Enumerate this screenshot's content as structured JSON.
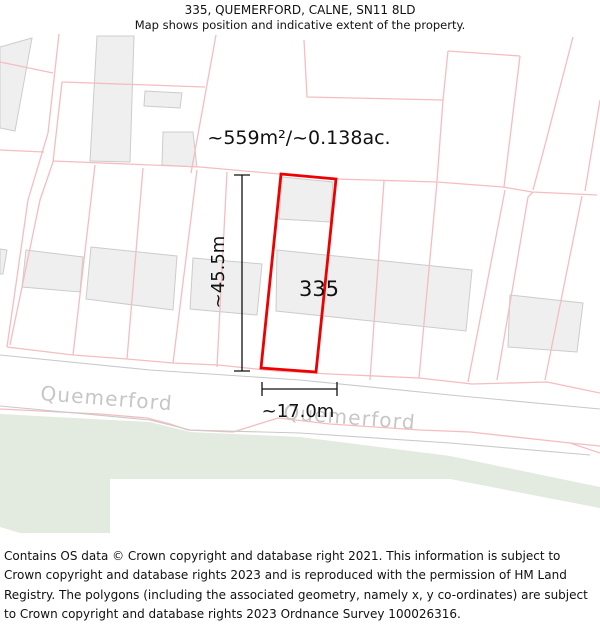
{
  "header": {
    "title": "335, QUEMERFORD, CALNE, SN11 8LD",
    "subtitle": "Map shows position and indicative extent of the property."
  },
  "map": {
    "area_label": "~559m²/~0.138ac.",
    "plot_number": "335",
    "depth_label": "~45.5m",
    "frontage_label": "~17.0m",
    "road_label_left": "Quemerford",
    "road_label_right": "Quemerford"
  },
  "footer": {
    "attribution": "Contains OS data © Crown copyright and database right 2021. This information is subject to Crown copyright and database rights 2023 and is reproduced with the permission of HM Land Registry. The polygons (including the associated geometry, namely x, y co-ordinates) are subject to Crown copyright and database rights 2023 Ordnance Survey 100026316."
  },
  "colors": {
    "plot_outline": "#ee0000",
    "parcel_line": "#f4bdc1",
    "building_fill": "#efefef",
    "building_stroke": "#cccccc",
    "road_edge": "#c9c9c9",
    "green_fill": "#e3eae0",
    "road_label": "#c6c6c6",
    "dimension": "#111111"
  }
}
